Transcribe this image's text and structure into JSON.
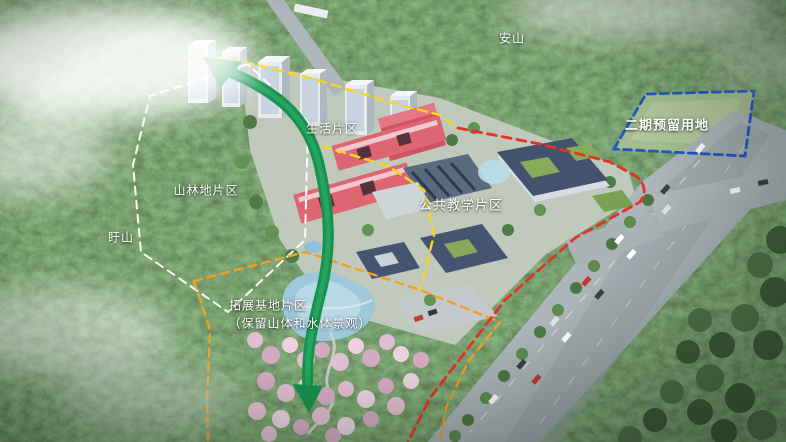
{
  "labels": {
    "anshan": "安山",
    "xushan": "盱山",
    "forest_zone": "山林地片区",
    "living_zone": "生活片区",
    "teaching_zone": "公共教学片区",
    "phase2_zone": "二期预留用地",
    "expansion_zone_line1": "拓展基地片区",
    "expansion_zone_line2": "（保留山体和水体景观）"
  },
  "colors": {
    "forest_boundary": "#ffffff",
    "campus_boundary": "#f6d51f",
    "expansion_boundary": "#f0a125",
    "roadside_boundary": "#e23325",
    "phase2_boundary": "#2257c4",
    "flow_arrow": "#17914e",
    "flow_arrow_light": "#2cab66"
  }
}
